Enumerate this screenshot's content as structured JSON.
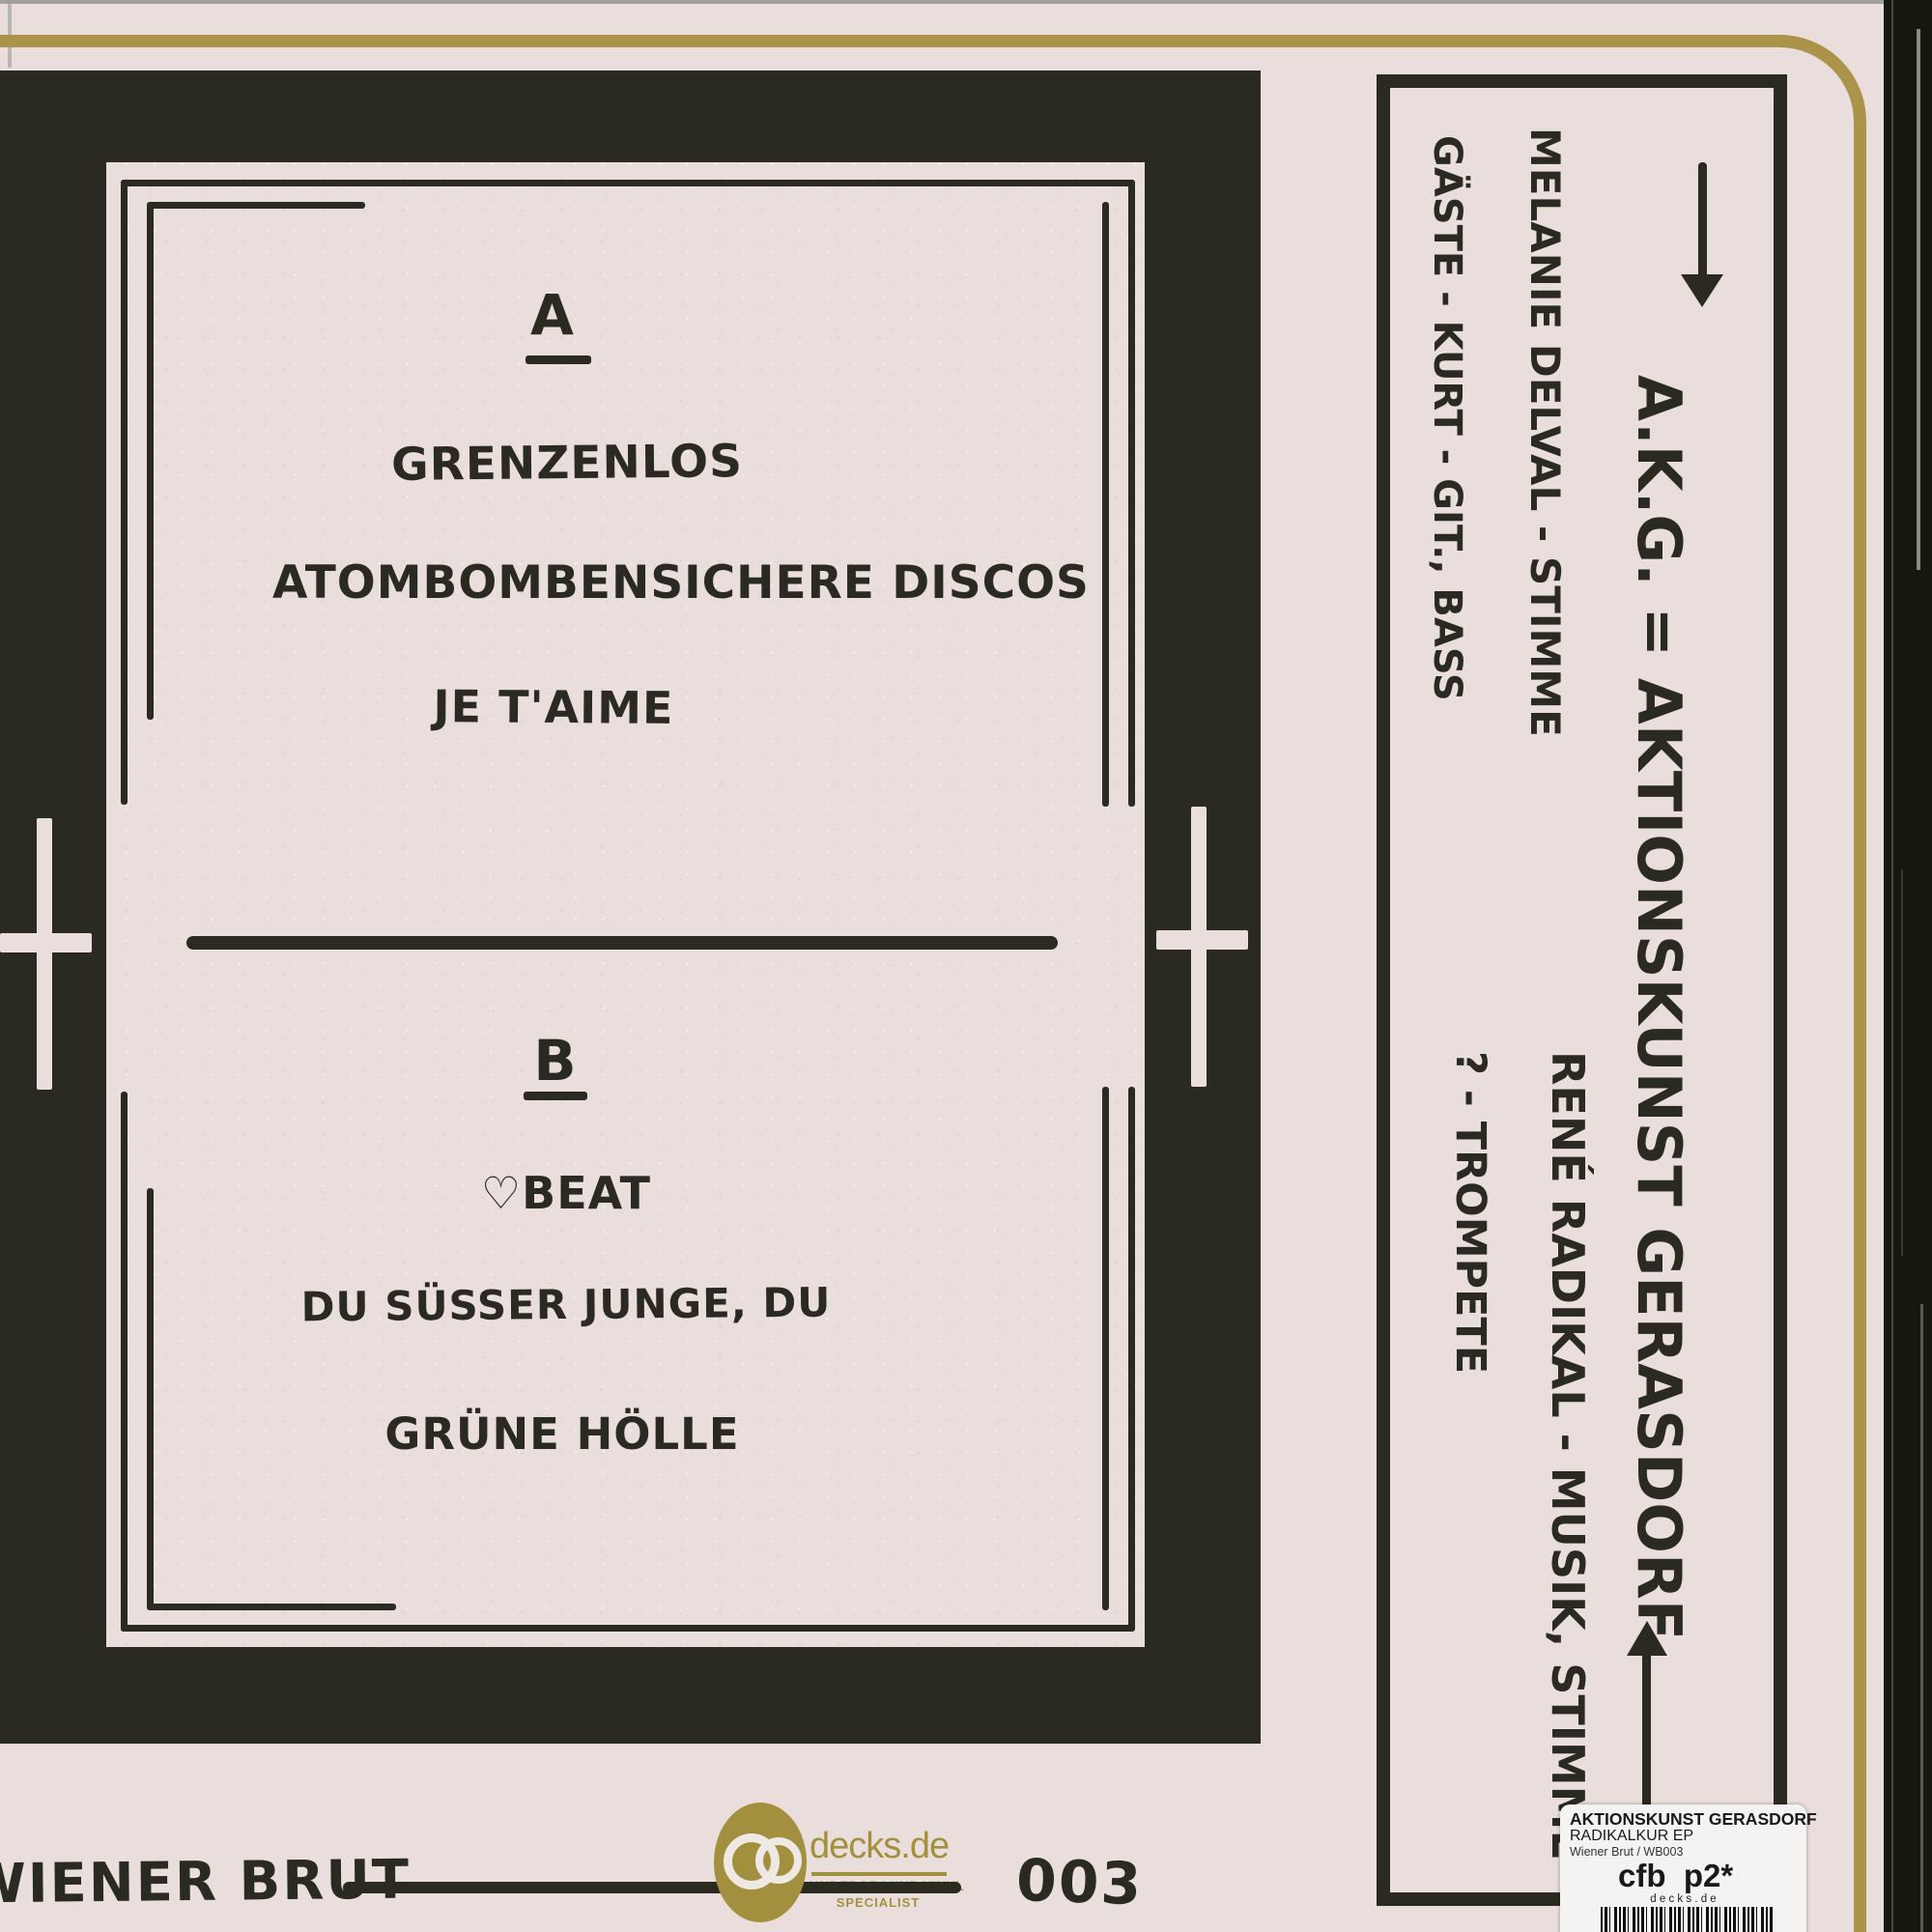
{
  "colors": {
    "paper": "#e9dedc",
    "ink": "#2b2a21",
    "gold_border": "#ab934a",
    "logo_gold": "#a3903f",
    "sticker_bg": "#f4f3f1",
    "edge_strip": "#17170f"
  },
  "tracklist": {
    "side_a": {
      "label": "A",
      "tracks": [
        "GRENZENLOS",
        "ATOMBOMBENSICHERE DISCOS",
        "JE T'AIME"
      ]
    },
    "side_b": {
      "label": "B",
      "heart_icon": "♡",
      "tracks": [
        "BEAT",
        "DU SÜSSER JUNGE, DU",
        "GRÜNE HÖLLE"
      ]
    }
  },
  "footer": {
    "label_name": "WIENER BRUT",
    "catalog_number": "003"
  },
  "shop_logo": {
    "name": "decks.de",
    "tagline_line1": "UNDERGROUND VINYL",
    "tagline_line2": "SPECIALIST"
  },
  "credits_panel": {
    "line_akg": "A.K.G. = AKTIONSKUNST GERASDORF",
    "line_melanie": "MELANIE DELVAL - STIMME",
    "line_gaeste": "GÄSTE - KURT - GIT., BASS",
    "line_rene": "RENÉ RADIKAL - MUSIK, STIMME",
    "line_trompete": "? - TROMPETE",
    "arrow_top": "down-arrow",
    "arrow_bottom": "up-arrow"
  },
  "sticker": {
    "artist": "AKTIONSKUNST GERASDORF",
    "title": "RADIKALKUR EP",
    "label_catalog": "Wiener Brut / WB003",
    "shop_code": "cfb  p2*",
    "shop_name": "d e c k s . d e"
  }
}
